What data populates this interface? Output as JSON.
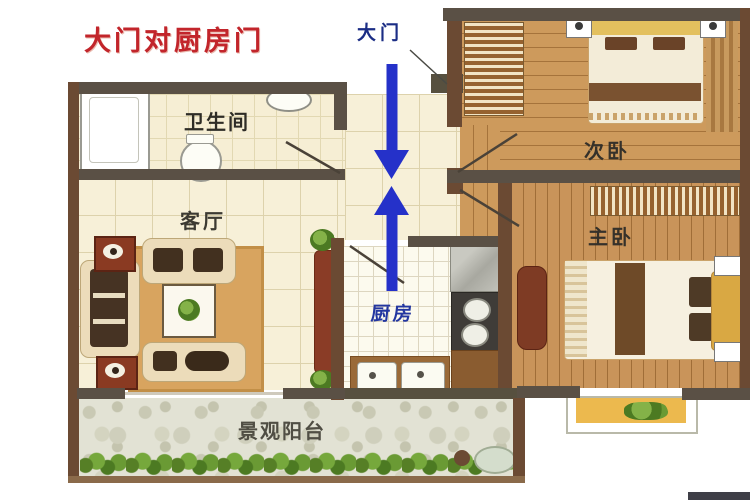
{
  "title": {
    "text": "大门对厨房门",
    "color": "#c2252b"
  },
  "rooms": {
    "main_door": {
      "label": "大门"
    },
    "bathroom": {
      "label": "卫生间"
    },
    "living_room": {
      "label": "客厅"
    },
    "kitchen": {
      "label": "厨房"
    },
    "secondary_bedroom": {
      "label": "次卧"
    },
    "master_bedroom": {
      "label": "主卧"
    },
    "balcony": {
      "label": "景观阳台"
    }
  },
  "icons": {
    "arrow_down": "arrow-down-icon",
    "arrow_up": "arrow-up-icon",
    "door_swing": "door-swing-line",
    "bathtub": "bathtub-icon",
    "toilet": "toilet-icon",
    "sink": "sink-icon",
    "sofa": "sofa-icon",
    "bed": "bed-icon",
    "wardrobe": "wardrobe-icon",
    "stove": "stove-icon",
    "plant": "plant-icon"
  },
  "colors": {
    "annotation_red": "#c2252b",
    "label_blue": "#1b2d85",
    "kitchen_label_blue": "#2336a0",
    "arrow_blue": "#2531c9",
    "wall_brown": "#6b4a33",
    "wall_gray": "#5a5045",
    "wood_floor": "#c18a4e",
    "tile_cream": "#f7f0d8",
    "balcony_stone": "#e2e2d4",
    "rug_tan": "#d8a45f",
    "bay_window_yellow": "#ecb94e"
  }
}
